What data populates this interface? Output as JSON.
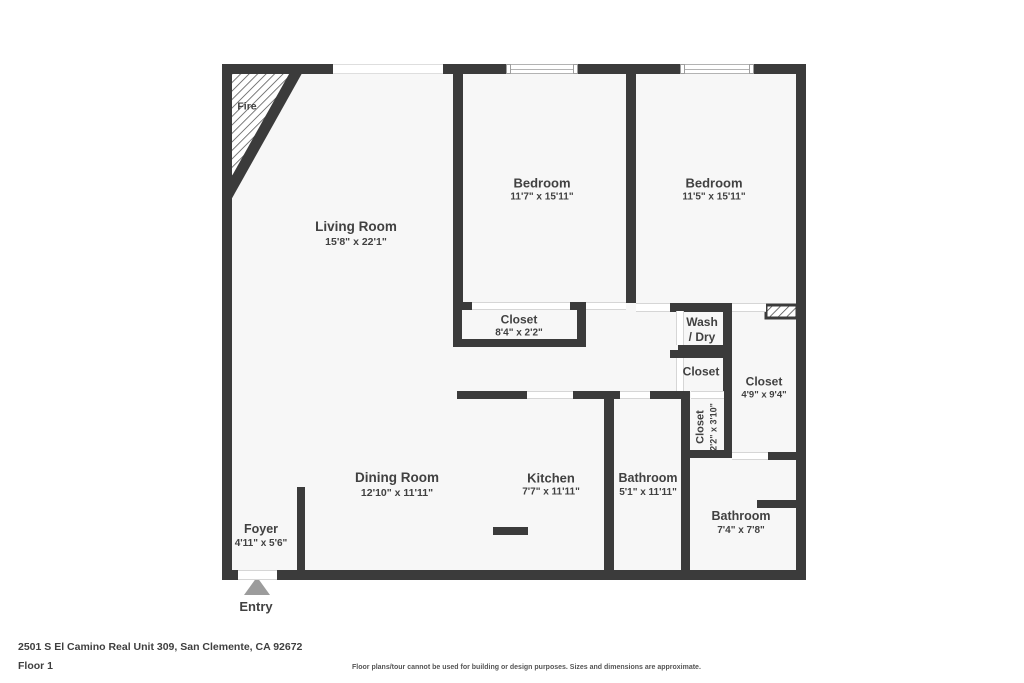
{
  "rooms": {
    "living": {
      "name": "Living Room",
      "dims": "15'8\" x 22'1\""
    },
    "bedroom1": {
      "name": "Bedroom",
      "dims": "11'7\" x 15'11\""
    },
    "bedroom2": {
      "name": "Bedroom",
      "dims": "11'5\" x 15'11\""
    },
    "closet1": {
      "name": "Closet",
      "dims": "8'4\" x 2'2\""
    },
    "washdry": {
      "name1": "Wash",
      "name2": "/ Dry"
    },
    "closet2": {
      "name": "Closet"
    },
    "closet3": {
      "name": "Closet",
      "dims": "4'9\" x 9'4\""
    },
    "closet4": {
      "name": "Closet",
      "dims": "2'2\" x 3'10\""
    },
    "dining": {
      "name": "Dining Room",
      "dims": "12'10\" x 11'11\""
    },
    "kitchen": {
      "name": "Kitchen",
      "dims": "7'7\" x 11'11\""
    },
    "bathroom1": {
      "name": "Bathroom",
      "dims": "5'1\" x 11'11\""
    },
    "bathroom2": {
      "name": "Bathroom",
      "dims": "7'4\" x 7'8\""
    },
    "foyer": {
      "name": "Foyer",
      "dims": "4'11\" x 5'6\""
    }
  },
  "annotations": {
    "fire": "Fire",
    "entry": "Entry"
  },
  "footer": {
    "address": "2501 S El Camino Real Unit 309, San Clemente, CA 92672",
    "floor": "Floor 1",
    "disclaimer": "Floor plans/tour cannot be used for building or design purposes. Sizes and dimensions are approximate."
  },
  "colors": {
    "wall": "#3b3b3b",
    "floor_fill": "#f7f7f7",
    "label_text": "#414141",
    "entry_arrow": "#9c9c9c"
  }
}
